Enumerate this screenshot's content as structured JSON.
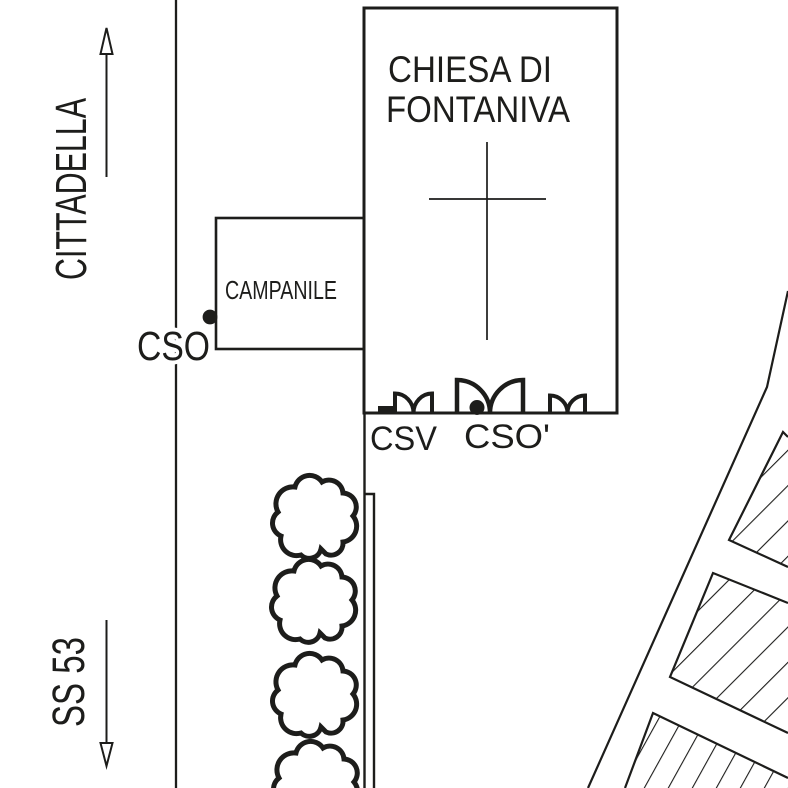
{
  "colors": {
    "ink": "#1d1d1b",
    "bg": "#ffffff"
  },
  "map": {
    "church": {
      "name_line1": "CHIESA DI",
      "name_line2": "FONTANIVA"
    },
    "campanile": {
      "label": "CAMPANILE"
    },
    "points": {
      "cso": "CSO",
      "csv": "CSV",
      "cso_prime": "CSO'"
    },
    "roads": {
      "north_destination": "CITTADELLA",
      "south_destination": "SS 53"
    }
  },
  "icons": {
    "north_arrow": "outline-arrow-up",
    "south_arrow": "outline-arrow-down",
    "church_cross": "latin-cross-lines",
    "tree": "cloud-outline-tree",
    "shrub": "double-leaf-shrub",
    "point_marker": "filled-dot",
    "city_blocks": "diagonal-hatch"
  }
}
